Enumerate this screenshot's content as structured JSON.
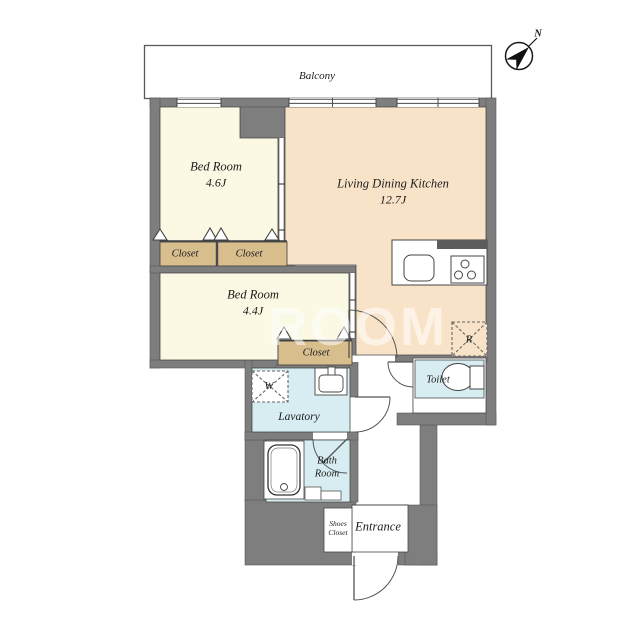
{
  "balcony": {
    "label": "Balcony"
  },
  "compass": {
    "label": "N"
  },
  "rooms": {
    "bedroom1": {
      "name": "Bed Room",
      "size": "4.6J"
    },
    "ldk": {
      "name": "Living Dining Kitchen",
      "size": "12.7J"
    },
    "bedroom2": {
      "name": "Bed Room",
      "size": "4.4J"
    },
    "closet1": {
      "label": "Closet"
    },
    "closet2": {
      "label": "Closet"
    },
    "closet3": {
      "label": "Closet"
    },
    "lavatory": {
      "label": "Lavatory"
    },
    "toilet": {
      "label": "Toilet"
    },
    "bath": {
      "line1": "Bath",
      "line2": "Room"
    },
    "entrance": {
      "label": "Entrance"
    },
    "shoes_closet": {
      "line1": "Shoes",
      "line2": "Closet"
    }
  },
  "fixtures": {
    "washer": "W",
    "refrigerator": "R"
  },
  "watermark": "ROOM",
  "colors": {
    "wall": "#7e7e7e",
    "bedroom_floor": "#fbf8e3",
    "ldk_floor": "#f8e3c8",
    "closet_fill": "#d8bd8d",
    "wet_area": "#d8edf1",
    "outline": "#4a4a4a"
  }
}
